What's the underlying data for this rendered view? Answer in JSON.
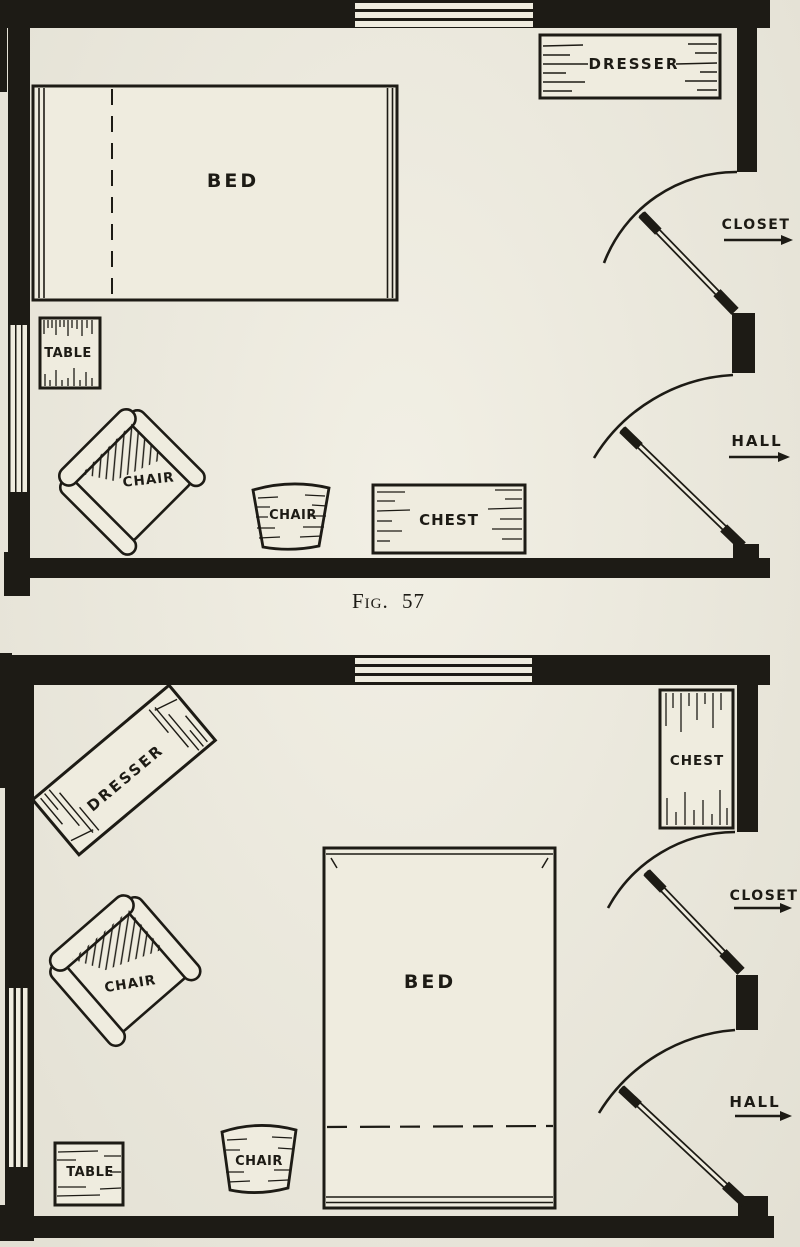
{
  "page": {
    "paper_color": "#efecdf",
    "ink_color": "#1d1b15",
    "caption": "Fig. 57"
  },
  "plan_top": {
    "labels": {
      "bed": "BED",
      "dresser": "DRESSER",
      "table": "TABLE",
      "armchair": "CHAIR",
      "side_chair": "CHAIR",
      "chest": "CHEST",
      "closet": "CLOSET",
      "hall": "HALL"
    }
  },
  "plan_bottom": {
    "labels": {
      "bed": "BED",
      "dresser": "DRESSER",
      "table": "TABLE",
      "armchair": "CHAIR",
      "side_chair": "CHAIR",
      "chest": "CHEST",
      "closet": "CLOSET",
      "hall": "HALL"
    }
  }
}
